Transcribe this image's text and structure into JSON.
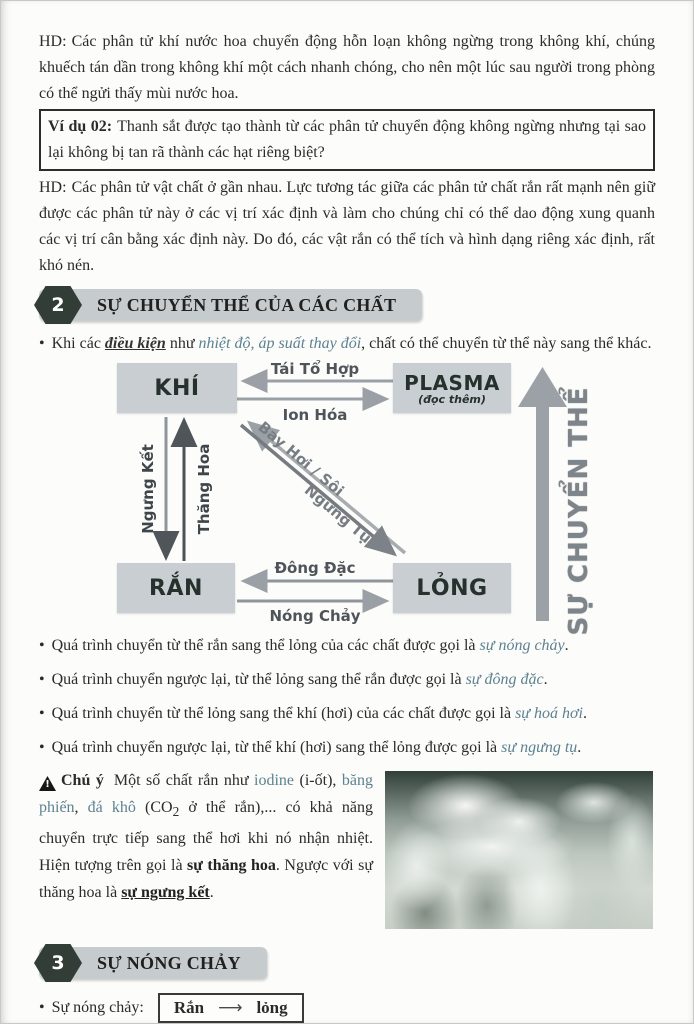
{
  "glyphs": {
    "bullet": "•"
  },
  "colors": {
    "accent_teal": "#5d8191",
    "section_bar": "#c6cbce",
    "section_badge": "#323d38",
    "diagram_box": "#c9ced2",
    "arrow_gray": "#9aa0a5",
    "arrow_dark": "#54595d"
  },
  "paragraphs": {
    "hd1": {
      "label": "HD:",
      "text": "Các phân tử khí nước hoa chuyển động hỗn loạn không ngừng trong không khí, chúng khuếch tán dần trong không khí một cách nhanh chóng, cho nên một lúc sau người trong phòng có thể ngửi thấy mùi nước hoa."
    },
    "vidu": {
      "label": "Ví dụ 02:",
      "text": "Thanh sắt được tạo thành từ các phân tử chuyển động không ngừng nhưng tại sao lại không bị tan rã thành các hạt riêng biệt?"
    },
    "hd2": {
      "label": "HD:",
      "text": "Các phân tử vật chất ở gần nhau. Lực tương tác giữa các phân tử chất rắn rất mạnh nên giữ được các phân tử này ở các vị trí xác định và làm cho chúng chỉ có thể dao động xung quanh các vị trí cân bằng xác định này. Do đó, các vật rắn có thể tích và hình dạng riêng xác định, rất khó nén."
    }
  },
  "sections": {
    "two": {
      "number": "2",
      "title": "SỰ CHUYỂN THỂ CỦA CÁC CHẤT"
    },
    "three": {
      "number": "3",
      "title": "SỰ NÓNG CHẢY"
    }
  },
  "intro_bullet": {
    "pre": "Khi các ",
    "underlined": "điều kiện",
    "mid": " như ",
    "accent": "nhiệt độ, áp suất thay đổi",
    "post": ", chất có thể chuyển từ thể này sang thể khác."
  },
  "diagram": {
    "nodes": {
      "gas": "KHÍ",
      "plasma": "PLASMA",
      "plasma_sub": "(đọc thêm)",
      "solid": "RẮN",
      "liquid": "LỎNG"
    },
    "arrows": {
      "recombination": "Tái Tổ Hợp",
      "ionization": "Ion Hóa",
      "deposition": "Ngưng Kết",
      "sublimation": "Thăng Hoa",
      "evaporation": "Bay Hơi / Sôi",
      "condensation": "Ngưng Tụ",
      "freezing": "Đông Đặc",
      "melting": "Nóng Chảy"
    },
    "axis_label": "SỰ CHUYỂN THỂ"
  },
  "bullets": [
    {
      "pre": "Quá trình chuyển từ thể rắn sang thể lỏng của các chất được gọi là ",
      "term": "sự nóng chảy",
      "post": "."
    },
    {
      "pre": "Quá trình chuyển ngược lại, từ thể lỏng sang thể rắn được gọi là ",
      "term": "sự đông đặc",
      "post": "."
    },
    {
      "pre": "Quá trình chuyển từ thể lỏng sang thể khí (hơi) của các chất được gọi là ",
      "term": "sự hoá hơi",
      "post": "."
    },
    {
      "pre": "Quá trình chuyển ngược lại, từ thể khí (hơi) sang thể lỏng được gọi là ",
      "term": "sự ngưng tụ",
      "post": "."
    }
  ],
  "note": {
    "warn_glyph": "!",
    "label": "Chú ý",
    "s1": "Một số chất rắn như ",
    "a1": "iodine",
    "s2": " (i-ốt), ",
    "a2": "băng phiến",
    "s3": ", ",
    "a3": "đá khô",
    "s4": " (CO",
    "sub": "2",
    "s5": " ở thể rắn),... có khả năng chuyển trực tiếp sang thể hơi khi nó nhận nhiệt. Hiện tượng trên gọi là ",
    "b1": "sự thăng hoa",
    "s6": ". Ngược với sự thăng hoa là ",
    "b2": "sự ngưng kết",
    "s7": "."
  },
  "melting_line": {
    "label": "Sự nóng chảy:",
    "from": "Rắn",
    "arrow": "⟶",
    "to": "lỏng"
  },
  "page": {
    "number": "3"
  }
}
